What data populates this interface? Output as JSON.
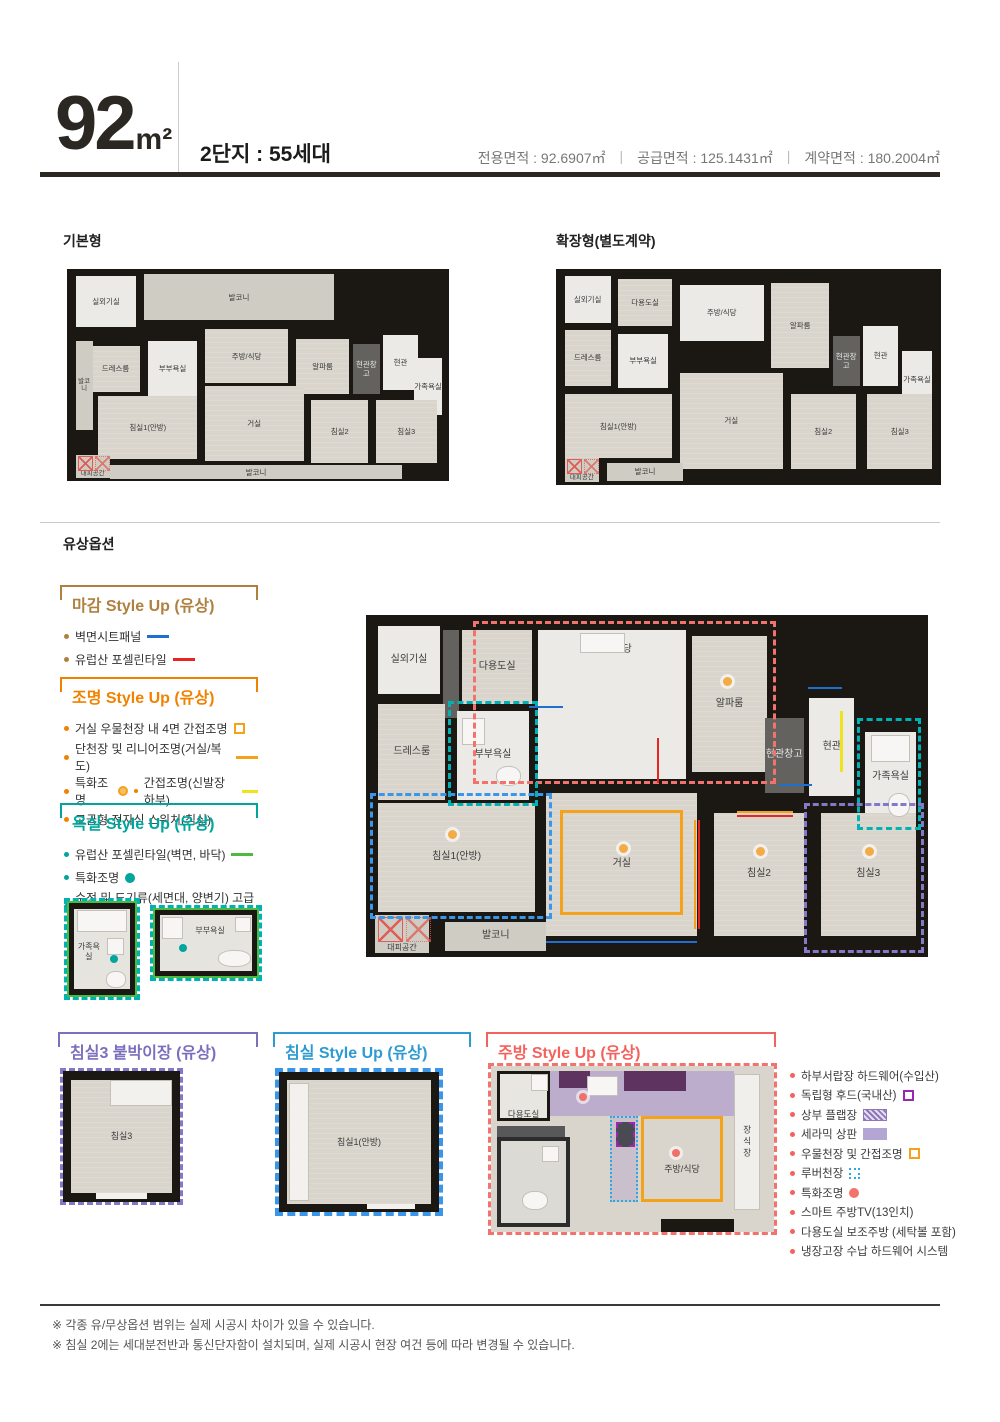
{
  "header": {
    "area_value": "92",
    "area_unit": "m²",
    "subtitle": "2단지 : 55세대",
    "separator": "|",
    "areas": [
      "전용면적 : 92.6907㎡",
      "공급면적 : 125.1431㎡",
      "계약면적 : 180.2004㎡"
    ]
  },
  "options_section_title": "유상옵션",
  "basic_plan": {
    "title": "기본형",
    "rooms": [
      "실외기실",
      "발코니",
      "드레스룸",
      "부부욕실",
      "주방/식당",
      "알파룸",
      "현관창고",
      "현관",
      "가족욕실",
      "발코니",
      "침실1(안방)",
      "거실",
      "침실2",
      "침실3",
      "발코니",
      "대피공간"
    ]
  },
  "extended_plan": {
    "title": "확장형(별도계약)",
    "rooms": [
      "실외기실",
      "다용도실",
      "주방/식당",
      "알파룸",
      "드레스룸",
      "부부욕실",
      "현관창고",
      "현관",
      "가족욕실",
      "침실1(안방)",
      "거실",
      "침실2",
      "침실3",
      "발코니",
      "대피공간"
    ]
  },
  "main_plan": {
    "rooms": [
      "실외기실",
      "다용도실",
      "주방/식당",
      "알파룸",
      "드레스룸",
      "부부욕실",
      "현관창고",
      "현관",
      "가족욕실",
      "침실1(안방)",
      "거실",
      "침실2",
      "침실3",
      "발코니",
      "대피공간"
    ]
  },
  "finish_option": {
    "title": "마감 Style Up (유상)",
    "items": [
      {
        "text": "벽면시트패널",
        "swatch": "blue-line"
      },
      {
        "text": "유럽산 포셀린타일",
        "swatch": "red-line"
      }
    ]
  },
  "lighting_option": {
    "title": "조명 Style Up (유상)",
    "items": [
      {
        "text": "거실 우물천장 내 4면 간접조명",
        "swatch": "orange-square-outline"
      },
      {
        "text": "단천장 및 리니어조명(거실/복도)",
        "swatch": "orange-line"
      },
      {
        "text": "특화조명",
        "swatch": "orange-dot"
      },
      {
        "text": "간접조명(신발장 하부)",
        "swatch": "yellow-line"
      },
      {
        "text": "고급형 전자식 스위치(침실)",
        "swatch": "none"
      }
    ]
  },
  "bath_option": {
    "title": "욕실 Style Up (유상)",
    "items": [
      {
        "text": "유럽산 포셀린타일(벽면, 바닥)",
        "swatch": "green-line"
      },
      {
        "text": "특화조명",
        "swatch": "teal-dot"
      },
      {
        "text": "수전 및 도기류(세면대, 양변기) 고급형",
        "swatch": "none"
      }
    ],
    "diagram_labels": [
      "가족욕실",
      "부부욕실"
    ]
  },
  "bedroom3_option": {
    "title": "침실3 붙박이장 (유상)",
    "room_label": "침실3"
  },
  "bedroom_option": {
    "title": "침실 Style Up (유상)",
    "room_label": "침실1(안방)"
  },
  "kitchen_option": {
    "title": "주방 Style Up (유상)",
    "diagram_labels": [
      "다용도실",
      "주방/식당",
      "장식장"
    ],
    "items": [
      {
        "text": "하부서랍장 하드웨어(수입산)",
        "swatch": "none"
      },
      {
        "text": "독립형 후드(국내산)",
        "swatch": "purple-dashed-square"
      },
      {
        "text": "상부 플랩장",
        "swatch": "purple-hatch"
      },
      {
        "text": "세라믹 상판",
        "swatch": "purple-solid"
      },
      {
        "text": "우물천장 및 간접조명",
        "swatch": "orange-square-outline"
      },
      {
        "text": "루버천장",
        "swatch": "blue-dotted-square"
      },
      {
        "text": "특화조명",
        "swatch": "red-dot"
      },
      {
        "text": "스마트 주방TV(13인치)",
        "swatch": "none"
      },
      {
        "text": "다용도실 보조주방 (세탁볼 포함)",
        "swatch": "none"
      },
      {
        "text": "냉장고장 수납 하드웨어 시스템",
        "swatch": "none"
      }
    ]
  },
  "footnotes": [
    "※ 각종 유/무상옵션 범위는 실제 시공시 차이가 있을 수 있습니다.",
    "※ 침실 2에는 세대분전반과 통신단자함이 설치되며, 실제 시공시 현장 여건 등에 따라 변경될 수 있습니다."
  ],
  "colors": {
    "finish_accent": "#b08040",
    "lighting_accent": "#f08200",
    "bath_accent": "#00a69e",
    "bedroom3_accent": "#7b6fbe",
    "bedroom_accent": "#2d9ad2",
    "kitchen_accent": "#f4625e",
    "sheet_panel_line": "#1e6fd0",
    "porcelain_tile_line": "#e8251f",
    "indirect_light_orange": "#f5a21b",
    "shoe_cabinet_light_yellow": "#f0e21c",
    "bath_tile_green": "#4cbb3c",
    "hood_purple": "#9b27af",
    "louver_blue": "#29abe2"
  }
}
